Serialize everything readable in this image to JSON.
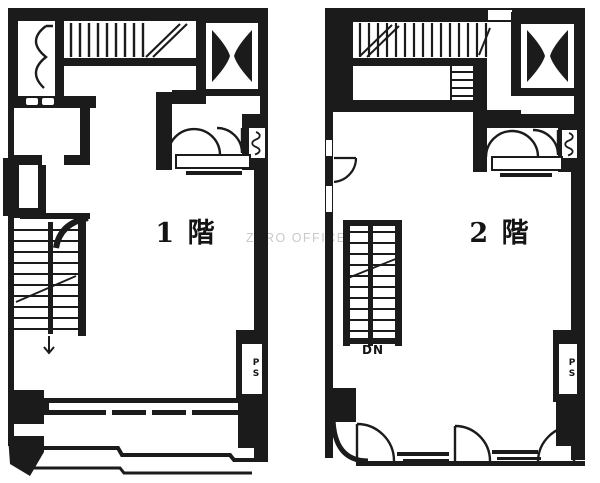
{
  "canvas": {
    "width": 600,
    "height": 483,
    "background": "#ffffff",
    "ink": "#1b1b1b"
  },
  "watermark": {
    "text": "ZERO OFFICE",
    "color": "#c9c9c9"
  },
  "plans": [
    {
      "name": "floor-1",
      "label": "1 階",
      "pipe_space_label": "PS"
    },
    {
      "name": "floor-2",
      "label": "2 階",
      "pipe_space_label": "PS",
      "stair_label": "DN"
    }
  ]
}
